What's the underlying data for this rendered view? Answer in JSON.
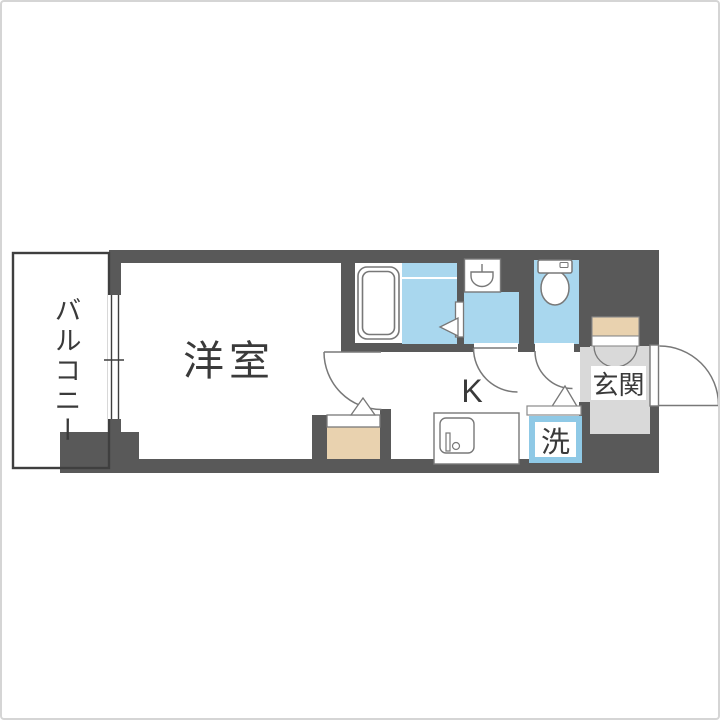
{
  "page": {
    "type": "real-estate floor plan (間取り図)",
    "background": "#ffffff",
    "frame_border": "#d5d5d5"
  },
  "floor_plan": {
    "labels": {
      "balcony": "バルコニー",
      "western_room": "洋室",
      "kitchen": "K",
      "laundry": "洗",
      "entrance": "玄関"
    },
    "rooms": [
      {
        "name": "balcony",
        "label": "バルコニー"
      },
      {
        "name": "western-room",
        "label": "洋室"
      },
      {
        "name": "kitchen",
        "label": "K"
      },
      {
        "name": "bathroom",
        "label": ""
      },
      {
        "name": "washroom",
        "label": ""
      },
      {
        "name": "toilet",
        "label": ""
      },
      {
        "name": "laundry-space",
        "label": "洗"
      },
      {
        "name": "entrance",
        "label": "玄関"
      }
    ],
    "fixtures": [
      "bathtub",
      "washbasin",
      "toilet",
      "kitchen-sink",
      "washing-machine-space",
      "shoe-cabinet",
      "closet"
    ],
    "colors": {
      "wall": "#595959",
      "water_area_blue": "#a9d7ee",
      "laundry_box_border_blue": "#8fc9e6",
      "storage_beige": "#e9d2af",
      "entrance_gray": "#d9d9d9",
      "fixture_outline": "#787878",
      "balcony_outline": "#3f3f3f",
      "text": "#3a3a3a"
    }
  }
}
